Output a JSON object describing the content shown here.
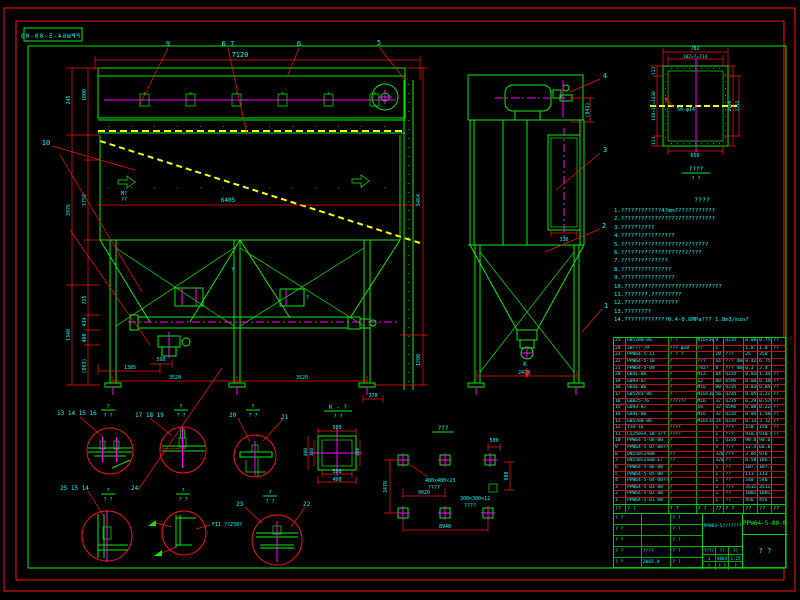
{
  "frame": {
    "corner_drawing_no": "PPW64-5-00-00"
  },
  "front_view": {
    "callouts": {
      "c9": "9",
      "c67": "6 7",
      "c6": "6",
      "c5": "5",
      "c10": "10"
    },
    "dims": {
      "top_7120": "7120",
      "left_245": "245",
      "left_3976": "3976",
      "left_1340": "1340",
      "left_1000": "1000",
      "left_1750": "1750",
      "left_725": "725",
      "left_434": "434",
      "left_400": "400",
      "left_863": "(863)",
      "mid_6405": "6405",
      "bot_1385": "1385",
      "bot_590": "590",
      "bot_3520a": "3520",
      "bot_3520b": "3520",
      "bot_370": "370",
      "right_5464": "5464",
      "right_1200": "1200"
    },
    "marks": {
      "m1": "M?",
      "m2": "??",
      "q1": "?",
      "q2": "?"
    }
  },
  "side_view": {
    "callouts": {
      "c1": "1",
      "c2": "2",
      "c3": "3",
      "c4": "4"
    },
    "dims": {
      "d841": "(841)",
      "d336": "336",
      "d2478": "2478"
    },
    "k_mark": "K"
  },
  "flange_detail": {
    "dims": {
      "d782": "782",
      "d714": "102×7=714",
      "d113a": "113",
      "d1430": "110×13=1430",
      "d113b": "113",
      "d2106": "2106",
      "d1332": "1332",
      "d656": "656"
    },
    "holes_label": "50-φ14",
    "title": "????",
    "scale": "? ?"
  },
  "notes": {
    "title": "????",
    "lines": [
      "1.????????????4?mm????????????",
      "2.????????????????????????????",
      "3.??????????",
      "4.????????????????",
      "5.??????????????????????????",
      "6.????????????????????????",
      "7.??????????????",
      "8.???????????????",
      "9.????????????????",
      "10.?????????????????????????????",
      "11.???????,?????????",
      "12.????????????????",
      "13.????????",
      "14.?????????????0.4-0.6MPa??? 1.8m3/min?"
    ]
  },
  "details": {
    "labels": {
      "g1": "13 14 15 16",
      "g2": "17 18 19",
      "g3": "20",
      "g4": "21",
      "g5": "25 15 14",
      "g6": "24",
      "g7": "23",
      "g8": "22"
    },
    "scale_num": "?",
    "scale_den": "? ?",
    "weld_note": "F11 ??250?"
  },
  "k_view": {
    "label": "K - ?",
    "scale": "? ?"
  },
  "base_plate": {
    "dims": {
      "t500": "500",
      "b550": "550",
      "b490": "490",
      "l400": "400",
      "l350": "350",
      "r306": "306"
    }
  },
  "anchor_layout": {
    "title": "???",
    "dims": {
      "v3478": "3478",
      "h9020": "9020",
      "h8940": "8940",
      "v600": "600",
      "h500": "500"
    },
    "plate_a": "480×480×23",
    "plate_a_note": "????",
    "plate_b": "300×300×12",
    "plate_b_note": "????"
  },
  "bom": {
    "header": [
      "??",
      "? ?",
      "? ?",
      "? ?",
      "??",
      "? ?",
      "??",
      "??",
      "??"
    ],
    "rows": [
      [
        "25",
        "GB5780-86",
        "? ?",
        "M16×50",
        "9",
        "Q235",
        "0.084",
        "0.754",
        "??"
      ],
      [
        "24",
        "JB???-79",
        "??? φ10",
        "??",
        "1",
        "",
        "1.8",
        "1.8",
        "??"
      ],
      [
        "23",
        "PPW64-5-11",
        "? ? ?",
        "",
        "10",
        "???",
        "25",
        "250",
        ""
      ],
      [
        "22",
        "PPW64-5-10",
        "?",
        "???",
        "14",
        "??? 4mm??",
        "0.423",
        "6.753",
        ""
      ],
      [
        "21",
        "PPW64-5-09",
        "?",
        "?42?",
        "8",
        "??? 4mm?",
        "0.3",
        "2.4",
        ""
      ],
      [
        "20",
        "GB41-86",
        "?",
        "M12",
        "84",
        "Q235",
        "0.016",
        "1.344",
        "??"
      ],
      [
        "19",
        "GB93-87",
        "?",
        "12",
        "80",
        "65Mn",
        "0.002",
        "0.168",
        "??"
      ],
      [
        "18",
        "GB41-86",
        "?",
        "M10",
        "80",
        "Q235",
        "0.010",
        "0.84",
        "??"
      ],
      [
        "17",
        "GB5781-86",
        "?",
        "M10×30",
        "56",
        "Q235",
        "0.057",
        "3.21",
        "??"
      ],
      [
        "16",
        "GB825-76",
        "??????",
        "M16",
        "32",
        "Q235",
        "0.29",
        "0.578",
        "??"
      ],
      [
        "15",
        "GB93-87",
        "?",
        "16",
        "32",
        "65Mn",
        "0.007",
        "0.224",
        "??"
      ],
      [
        "14",
        "GB41-86",
        "?",
        "M16",
        "32",
        "Q235",
        "0.047",
        "1.504",
        "??"
      ],
      [
        "13",
        "GB5780-86",
        "?",
        "M16×140",
        "24",
        "Q235",
        "0.13",
        "3.12",
        "??"
      ],
      [
        "12",
        "YJD-16",
        "????",
        "",
        "1",
        "???",
        "150",
        "150",
        "??"
      ],
      [
        "11",
        "LS250×4.18-3??",
        "????",
        "",
        "1",
        "???",
        "910.00",
        "910.00",
        "??"
      ],
      [
        "10",
        "PPW64-5-08-00",
        "?",
        "",
        "1",
        "Q235",
        "90.0",
        "90.0",
        ""
      ],
      [
        "9",
        "PPW64-5-07-00??",
        "?",
        "",
        "5",
        "???",
        "13.4",
        "66.8",
        ""
      ],
      [
        "8",
        "DN150×2400",
        "??",
        "",
        "320",
        "???",
        "3.05",
        "976",
        ""
      ],
      [
        "7",
        "DN150×2400-E?",
        "??",
        "",
        "320",
        "??",
        "0.58",
        "186.4",
        ""
      ],
      [
        "6",
        "PPW64-5-06-00",
        "?",
        "",
        "1",
        "??",
        "107.4",
        "107.4",
        ""
      ],
      [
        "5",
        "PPW64-5-05-00",
        "?",
        "",
        "1",
        "??",
        "113",
        "113",
        ""
      ],
      [
        "4",
        "PPW64-5-04-00??",
        "?",
        "",
        "1",
        "??",
        "540",
        "540",
        ""
      ],
      [
        "3",
        "PPW64-5-03-00",
        "?",
        "",
        "1",
        "???",
        "3511",
        "3511",
        ""
      ],
      [
        "2",
        "PPW64-5-02-00",
        "?",
        "",
        "1",
        "??",
        "1001",
        "1001",
        ""
      ],
      [
        "1",
        "PPW64-5-01-00",
        "?",
        "",
        "1",
        "??",
        "456",
        "456",
        ""
      ]
    ]
  },
  "title_block": {
    "product_name": "PPW64-5???????",
    "drawing_no": "PPW64-5-00-00",
    "stage": "? ?",
    "qty_label": "????",
    "weight_label": "??(Kg)",
    "scale_label": "??",
    "qty": "1",
    "weight": "8804",
    "scale": "1:25",
    "r3a": "?",
    "r3b": "? ?",
    "r3c": "?",
    "sig": "? ?",
    "mark_row": "????",
    "date": "2002.4"
  }
}
